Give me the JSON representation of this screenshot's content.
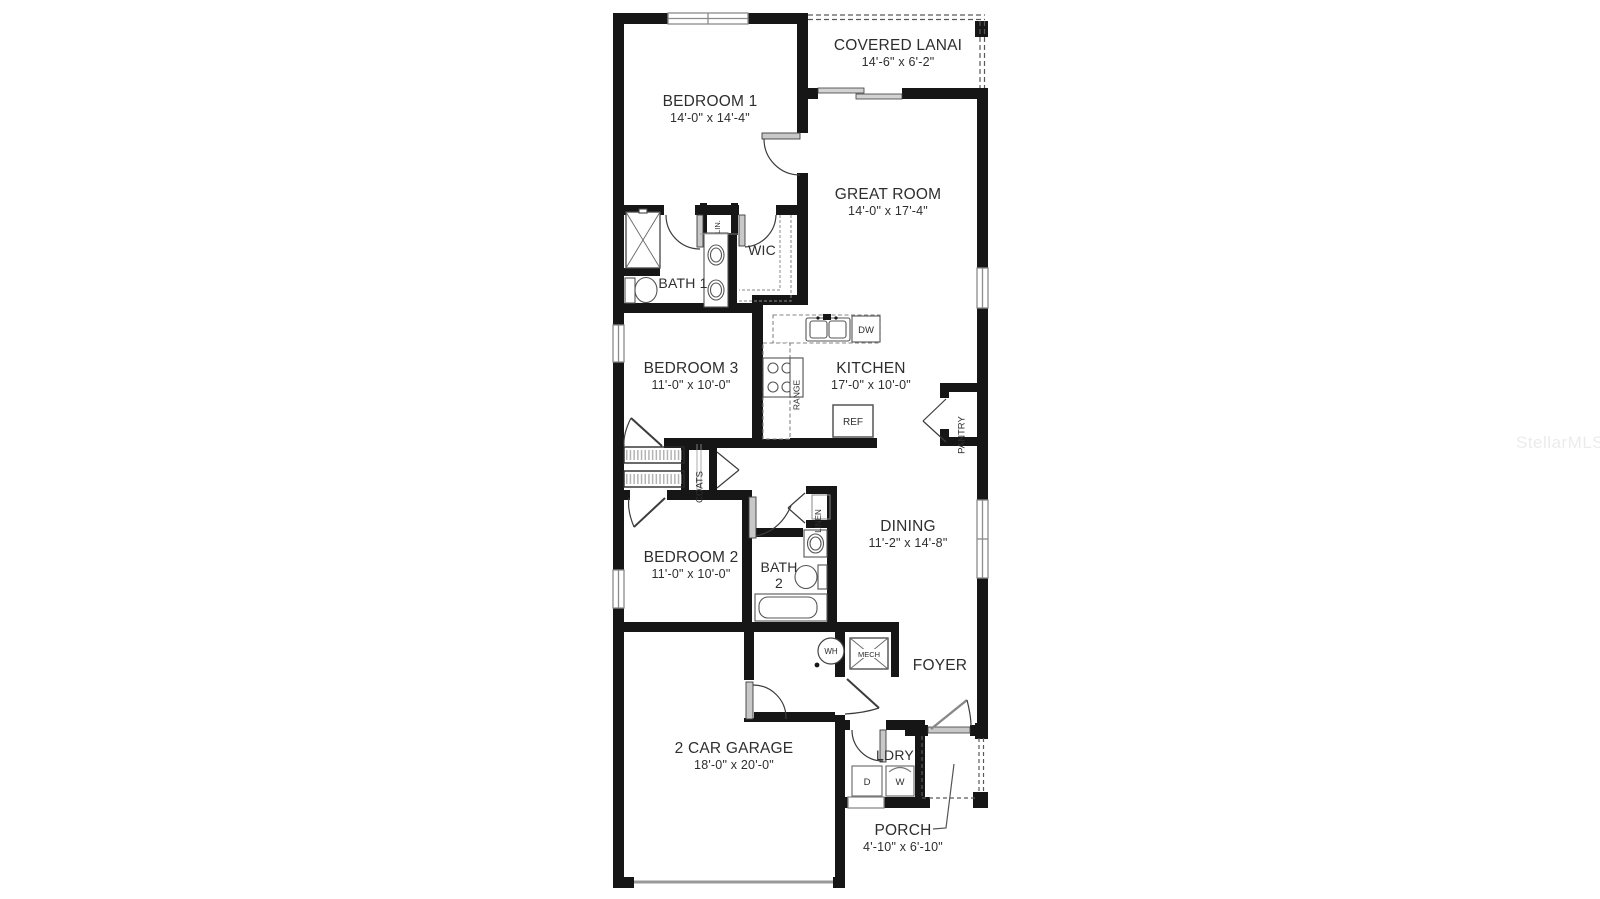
{
  "watermark": "StellarMLS",
  "rooms": {
    "covered_lanai": {
      "label": "COVERED LANAI",
      "dims": "14'-6\" x 6'-2\""
    },
    "bedroom1": {
      "label": "BEDROOM 1",
      "dims": "14'-0\" x 14'-4\""
    },
    "great_room": {
      "label": "GREAT ROOM",
      "dims": "14'-0\" x 17'-4\""
    },
    "bath1": {
      "label": "BATH 1"
    },
    "wic": {
      "label": "WIC"
    },
    "bedroom3": {
      "label": "BEDROOM 3",
      "dims": "11'-0\" x 10'-0\""
    },
    "kitchen": {
      "label": "KITCHEN",
      "dims": "17'-0\" x 10'-0\""
    },
    "dining": {
      "label": "DINING",
      "dims": "11'-2\" x 14'-8\""
    },
    "bedroom2": {
      "label": "BEDROOM 2",
      "dims": "11'-0\" x 10'-0\""
    },
    "bath2": {
      "label_line1": "BATH",
      "label_line2": "2"
    },
    "foyer": {
      "label": "FOYER"
    },
    "garage": {
      "label": "2 CAR GARAGE",
      "dims": "18'-0\" x 20'-0\""
    },
    "laundry": {
      "label": "LDRY"
    },
    "porch": {
      "label": "PORCH",
      "dims": "4'-10\" x 6'-10\""
    }
  },
  "closets": {
    "lin": "LIN.",
    "linen": "LINEN",
    "coats": "COATS",
    "pantry": "PANTRY"
  },
  "appliances": {
    "dw": "DW",
    "range": "RANGE",
    "ref": "REF",
    "dryer": "D",
    "washer": "W",
    "water_heater": "WH",
    "mech": "MECH"
  },
  "colors": {
    "walls": "#161616",
    "text": "#2e2e2e",
    "fixture_line": "#555555"
  }
}
